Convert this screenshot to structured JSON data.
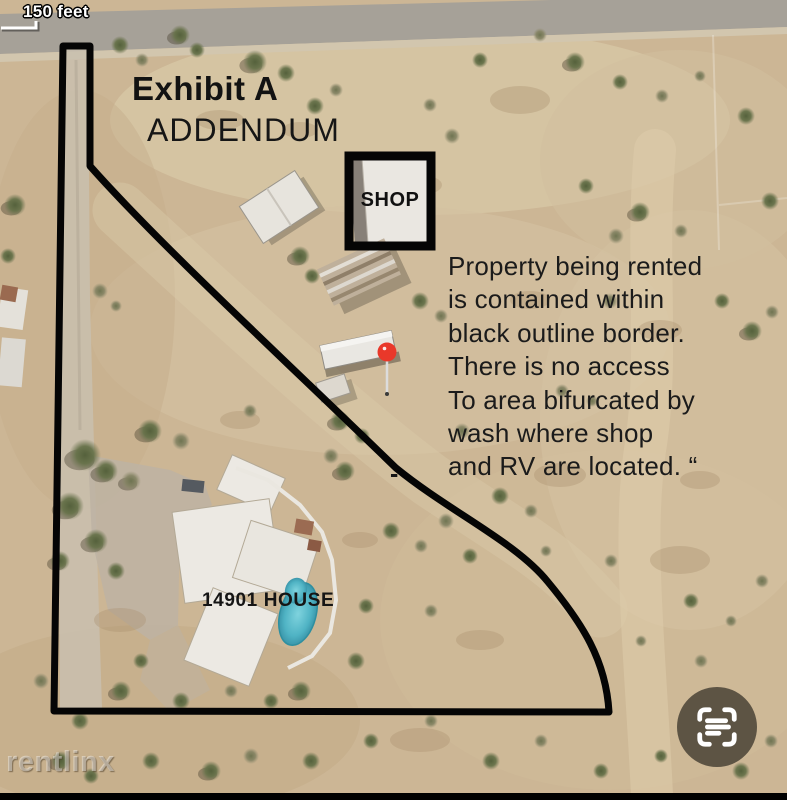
{
  "scale": {
    "label": "150 feet"
  },
  "titles": {
    "exhibit": "Exhibit A",
    "addendum": "ADDENDUM"
  },
  "labels": {
    "shop": "SHOP",
    "house": "14901 HOUSE",
    "dash": "-"
  },
  "note": {
    "text": "Property being rented\nis contained within\nblack outline border.\nThere is no access\nTo area bifurcated by\nwash where shop\nand RV are located. “"
  },
  "watermark": {
    "text": "rentlinx"
  },
  "icons": {
    "bottom_right": "scan-text-icon",
    "map_marker": "map-pin-icon"
  },
  "colors": {
    "boundary": "#050505",
    "shop_outline": "#050505",
    "pin_red": "#e9382a",
    "pool_teal": "#55bac9",
    "scan_button_bg": "rgba(71,64,53,0.84)",
    "scale_text": "#ffffff"
  }
}
